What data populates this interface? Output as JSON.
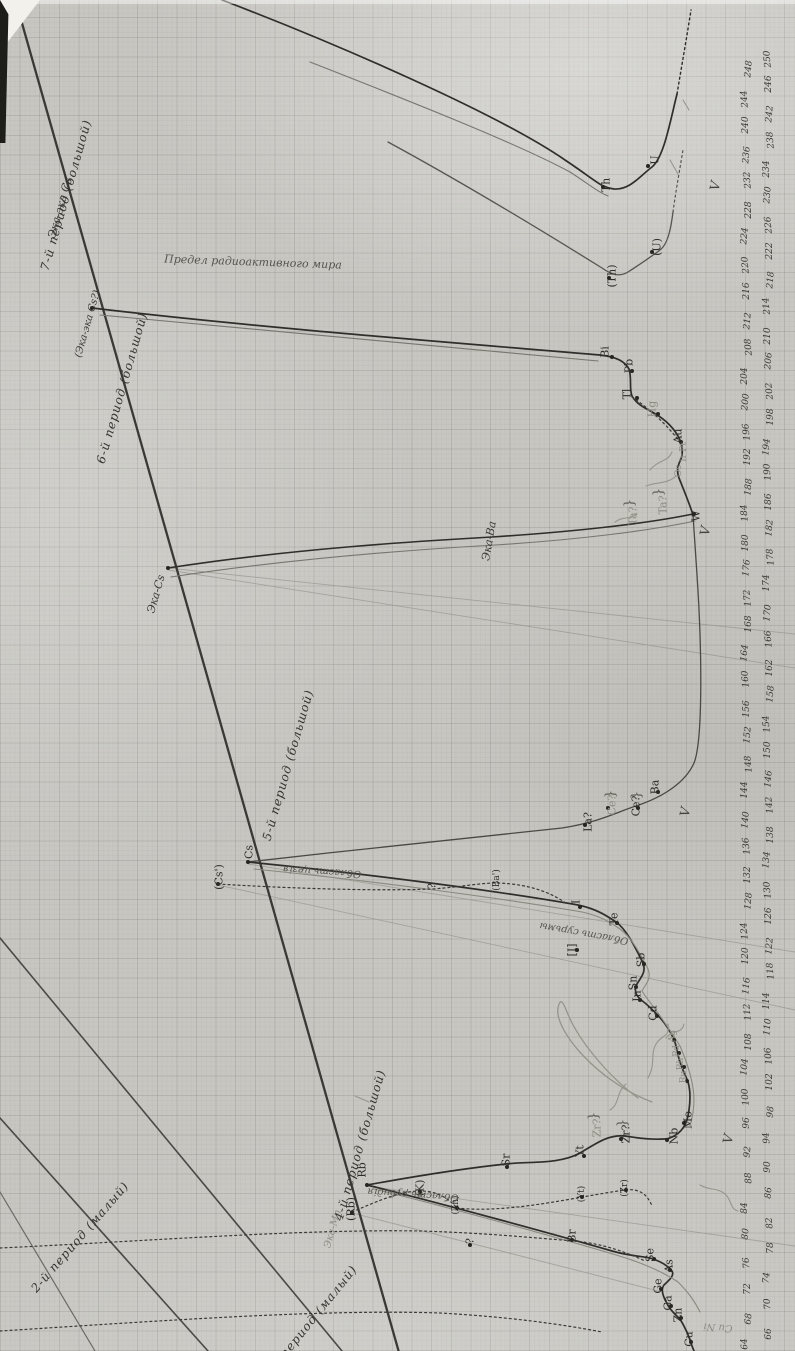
{
  "document": {
    "kind": "scanned hand-drawn manuscript chart on squared paper",
    "language": "Russian",
    "subject": "Periodic curves of the chemical elements plotted against atomic weight"
  },
  "axis": {
    "label": "atomic weight",
    "min": 64,
    "max": 250,
    "step": 2,
    "orientation": "vertical along right edge, values increase upward, numerals rotated"
  },
  "chart_data": {
    "type": "line",
    "title": "",
    "xlabel": "атомный вес (atomic weight)",
    "ylabel": "",
    "axis_range": [
      60,
      250
    ],
    "grid": "on (squared paper)",
    "series": [
      {
        "name": "4-й период (большой)",
        "elements": [
          "Cu",
          "Zn",
          "Ga",
          "Ge",
          "As",
          "Se",
          "Br"
        ],
        "x": [
          63.5,
          65.4,
          69.7,
          72.6,
          75.0,
          79.0,
          80.0
        ]
      },
      {
        "name": "5-й период (большой)",
        "elements": [
          "Rb",
          "Sr",
          "Yt",
          "Zr",
          "Nb",
          "Mo",
          "Ru",
          "Rh",
          "Pd",
          "Ag",
          "Cd",
          "In",
          "Sn",
          "Sb",
          "Te",
          "I"
        ],
        "x": [
          85.4,
          87.6,
          89.0,
          90.6,
          94.0,
          96.0,
          101.7,
          103.0,
          106.7,
          107.9,
          112.4,
          114.8,
          118.7,
          120.2,
          127.5,
          126.9
        ]
      },
      {
        "name": "6-й период (большой)",
        "elements": [
          "Cs",
          "Ba",
          "La?",
          "Ce?",
          "Ta?",
          "W",
          "Os",
          "Ir",
          "Pt",
          "Au",
          "Hg",
          "Tl",
          "Pb",
          "Bi"
        ],
        "x": [
          132.9,
          137.4,
          138.9,
          140.2,
          181.0,
          184.0,
          190.9,
          193.1,
          195.2,
          197.2,
          200.6,
          204.4,
          207.2,
          209.0
        ]
      },
      {
        "name": "7-й период (большой)",
        "elements": [
          "Th",
          "U",
          "(Th)",
          "(U)"
        ],
        "x": [
          232.1,
          238.1,
          232.1,
          238.1
        ]
      },
      {
        "name": "предсказанные (predicted)",
        "elements": [
          "Эка-Cs",
          "Эка-Ba",
          "Эка-Mn",
          "Эка-эка Cs"
        ],
        "x": [
          187.0,
          189.0,
          99.0,
          231.0
        ]
      }
    ],
    "alkali_line": "straight diagonal line through Rb, Cs, Эка-Cs, Эка-эка Cs marking period boundaries"
  },
  "element_labels": [
    {
      "t": "U",
      "x": 655,
      "y": 160,
      "s": "ink"
    },
    {
      "t": "Th",
      "x": 606,
      "y": 185,
      "s": "ink"
    },
    {
      "t": "(U)",
      "x": 657,
      "y": 247,
      "s": "ink"
    },
    {
      "t": "(Th)",
      "x": 612,
      "y": 276,
      "s": "ink"
    },
    {
      "t": "Bi",
      "x": 605,
      "y": 352,
      "s": "ink"
    },
    {
      "t": "Pb",
      "x": 629,
      "y": 366,
      "s": "ink"
    },
    {
      "t": "Tl",
      "x": 627,
      "y": 394,
      "s": "ink"
    },
    {
      "t": "Hg",
      "x": 652,
      "y": 409,
      "s": "pencil"
    },
    {
      "t": "Au",
      "x": 678,
      "y": 436,
      "s": "ink"
    },
    {
      "t": "Pt",
      "x": 684,
      "y": 447,
      "s": "pencil",
      "fs": 9
    },
    {
      "t": "Ir",
      "x": 684,
      "y": 458,
      "s": "pencil",
      "fs": 9
    },
    {
      "t": "Os",
      "x": 679,
      "y": 471,
      "s": "pencil",
      "fs": 9
    },
    {
      "t": "W",
      "x": 696,
      "y": 516,
      "s": "ink"
    },
    {
      "t": "Ta?",
      "x": 663,
      "y": 505,
      "s": "pencil"
    },
    {
      "t": "Ta?",
      "x": 633,
      "y": 516,
      "s": "pencil"
    },
    {
      "t": "Ba",
      "x": 655,
      "y": 787,
      "s": "ink"
    },
    {
      "t": "La?",
      "x": 588,
      "y": 822,
      "s": "ink"
    },
    {
      "t": "Ce?",
      "x": 612,
      "y": 805,
      "s": "pencil"
    },
    {
      "t": "Ce?",
      "x": 636,
      "y": 806,
      "s": "ink"
    },
    {
      "t": "Cs",
      "x": 249,
      "y": 852,
      "s": "ink"
    },
    {
      "t": "(Cs')",
      "x": 219,
      "y": 877,
      "s": "ink"
    },
    {
      "t": "?",
      "x": 432,
      "y": 886,
      "s": "ink"
    },
    {
      "t": "(Ba')",
      "x": 497,
      "y": 880,
      "s": "ink",
      "fs": 9
    },
    {
      "t": "I",
      "x": 576,
      "y": 902,
      "s": "ink"
    },
    {
      "t": "Te",
      "x": 614,
      "y": 919,
      "s": "ink"
    },
    {
      "t": "[I]",
      "x": 572,
      "y": 950,
      "s": "ink"
    },
    {
      "t": "Sb",
      "x": 641,
      "y": 960,
      "s": "ink"
    },
    {
      "t": "Sn",
      "x": 633,
      "y": 983,
      "s": "ink"
    },
    {
      "t": "In",
      "x": 637,
      "y": 996,
      "s": "ink"
    },
    {
      "t": "Cd",
      "x": 653,
      "y": 1013,
      "s": "ink"
    },
    {
      "t": "Ag",
      "x": 673,
      "y": 1036,
      "s": "pencil",
      "fs": 9
    },
    {
      "t": "Pd",
      "x": 677,
      "y": 1051,
      "s": "pencil",
      "fs": 9
    },
    {
      "t": "Rh",
      "x": 681,
      "y": 1064,
      "s": "pencil",
      "fs": 9
    },
    {
      "t": "Ru",
      "x": 684,
      "y": 1077,
      "s": "pencil",
      "fs": 9
    },
    {
      "t": "Mo",
      "x": 688,
      "y": 1120,
      "s": "ink"
    },
    {
      "t": "Nb",
      "x": 674,
      "y": 1136,
      "s": "ink"
    },
    {
      "t": "Zr?",
      "x": 626,
      "y": 1134,
      "s": "ink"
    },
    {
      "t": "Zr?",
      "x": 597,
      "y": 1128,
      "s": "pencil"
    },
    {
      "t": "Yt",
      "x": 580,
      "y": 1151,
      "s": "ink"
    },
    {
      "t": "Sr",
      "x": 506,
      "y": 1160,
      "s": "ink"
    },
    {
      "t": "Rb",
      "x": 362,
      "y": 1170,
      "s": "ink"
    },
    {
      "t": "(Rb)",
      "x": 351,
      "y": 1209,
      "s": "ink"
    },
    {
      "t": "(K)",
      "x": 420,
      "y": 1188,
      "s": "ink"
    },
    {
      "t": "(Zn)",
      "x": 456,
      "y": 1205,
      "s": "ink",
      "fs": 9
    },
    {
      "t": "(Zr)",
      "x": 625,
      "y": 1188,
      "s": "ink",
      "fs": 9
    },
    {
      "t": "(Yt)",
      "x": 582,
      "y": 1194,
      "s": "ink",
      "fs": 9
    },
    {
      "t": "Br",
      "x": 572,
      "y": 1236,
      "s": "ink"
    },
    {
      "t": "?",
      "x": 470,
      "y": 1241,
      "s": "ink"
    },
    {
      "t": "Se",
      "x": 650,
      "y": 1255,
      "s": "ink"
    },
    {
      "t": "As",
      "x": 669,
      "y": 1266,
      "s": "ink"
    },
    {
      "t": "Ge",
      "x": 658,
      "y": 1286,
      "s": "ink"
    },
    {
      "t": "Ga",
      "x": 668,
      "y": 1303,
      "s": "ink"
    },
    {
      "t": "Zn",
      "x": 678,
      "y": 1315,
      "s": "ink"
    },
    {
      "t": "Cu",
      "x": 689,
      "y": 1339,
      "s": "ink"
    }
  ],
  "predicted_labels": [
    {
      "t": "Эка-эка Cs",
      "x": 60,
      "y": 208,
      "r": -74,
      "fs": 11
    },
    {
      "t": "(Эка-эка Cs?)",
      "x": 88,
      "y": 324,
      "r": -74,
      "fs": 10
    },
    {
      "t": "Эка-Cs",
      "x": 156,
      "y": 594,
      "r": -74,
      "fs": 11
    },
    {
      "t": "Эка-Ba",
      "x": 489,
      "y": 541,
      "r": -80,
      "fs": 11
    },
    {
      "t": "Эка-Mn",
      "x": 333,
      "y": 1229,
      "r": -74,
      "fs": 10,
      "s": "pencilcur"
    },
    {
      "t": "Cu Ni",
      "x": 718,
      "y": 1327,
      "r": 184,
      "fs": 10,
      "s": "pencilcur"
    }
  ],
  "period_labels": [
    {
      "t": "7-й период (большой)",
      "x": 66,
      "y": 195,
      "r": -74
    },
    {
      "t": "6-й период (большой)",
      "x": 122,
      "y": 388,
      "r": -74
    },
    {
      "t": "5-й период (большой)",
      "x": 288,
      "y": 765,
      "r": -74
    },
    {
      "t": "4-й период (большой)",
      "x": 360,
      "y": 1145,
      "r": -74
    },
    {
      "t": "3-й период (малый)",
      "x": 310,
      "y": 1322,
      "r": -51
    },
    {
      "t": "2-й период (малый)",
      "x": 80,
      "y": 1237,
      "r": -49
    }
  ],
  "annotations": [
    {
      "t": "Предел радиоактивного мира",
      "x": 253,
      "y": 262,
      "r": 2,
      "fs": 11,
      "s": "note"
    },
    {
      "t": "Область цезія",
      "x": 322,
      "y": 871,
      "r": 184,
      "fs": 10,
      "s": "note"
    },
    {
      "t": "Область рубидія",
      "x": 413,
      "y": 1194,
      "r": 184,
      "fs": 10,
      "s": "note"
    },
    {
      "t": "Область сурьмы",
      "x": 584,
      "y": 933,
      "r": 190,
      "fs": 10,
      "s": "note"
    }
  ],
  "checkmarks": [
    [
      716,
      186
    ],
    [
      706,
      531
    ],
    [
      686,
      812
    ],
    [
      729,
      1139
    ]
  ],
  "braces": [
    [
      659,
      492
    ],
    [
      630,
      503
    ],
    [
      594,
      1116
    ],
    [
      623,
      1123
    ],
    [
      611,
      794
    ],
    [
      637,
      795
    ]
  ],
  "dots": [
    [
      603,
      187
    ],
    [
      648,
      166
    ],
    [
      609,
      278
    ],
    [
      652,
      252
    ],
    [
      612,
      357
    ],
    [
      632,
      371
    ],
    [
      637,
      398
    ],
    [
      658,
      414
    ],
    [
      681,
      442
    ],
    [
      694,
      514
    ],
    [
      168,
      568
    ],
    [
      92,
      308
    ],
    [
      658,
      792
    ],
    [
      585,
      825
    ],
    [
      608,
      808
    ],
    [
      638,
      808
    ],
    [
      248,
      862
    ],
    [
      218,
      884
    ],
    [
      507,
      1167
    ],
    [
      584,
      1156
    ],
    [
      621,
      1139
    ],
    [
      667,
      1140
    ],
    [
      684,
      1123
    ],
    [
      687,
      1081
    ],
    [
      684,
      1067
    ],
    [
      679,
      1053
    ],
    [
      674,
      1040
    ],
    [
      657,
      1016
    ],
    [
      640,
      1000
    ],
    [
      636,
      987
    ],
    [
      644,
      964
    ],
    [
      617,
      923
    ],
    [
      580,
      907
    ],
    [
      577,
      950
    ],
    [
      367,
      1185
    ],
    [
      352,
      1213
    ],
    [
      420,
      1192
    ],
    [
      457,
      1208
    ],
    [
      626,
      1190
    ],
    [
      582,
      1197
    ],
    [
      572,
      1240
    ],
    [
      470,
      1245
    ],
    [
      654,
      1259
    ],
    [
      670,
      1270
    ],
    [
      661,
      1289
    ],
    [
      671,
      1306
    ],
    [
      681,
      1318
    ],
    [
      691,
      1342
    ]
  ],
  "colors": {
    "ink": "#2e2d29",
    "pencil": "#8d8c83",
    "paper": "#c7c6c1",
    "crease": "#3a3a34"
  }
}
